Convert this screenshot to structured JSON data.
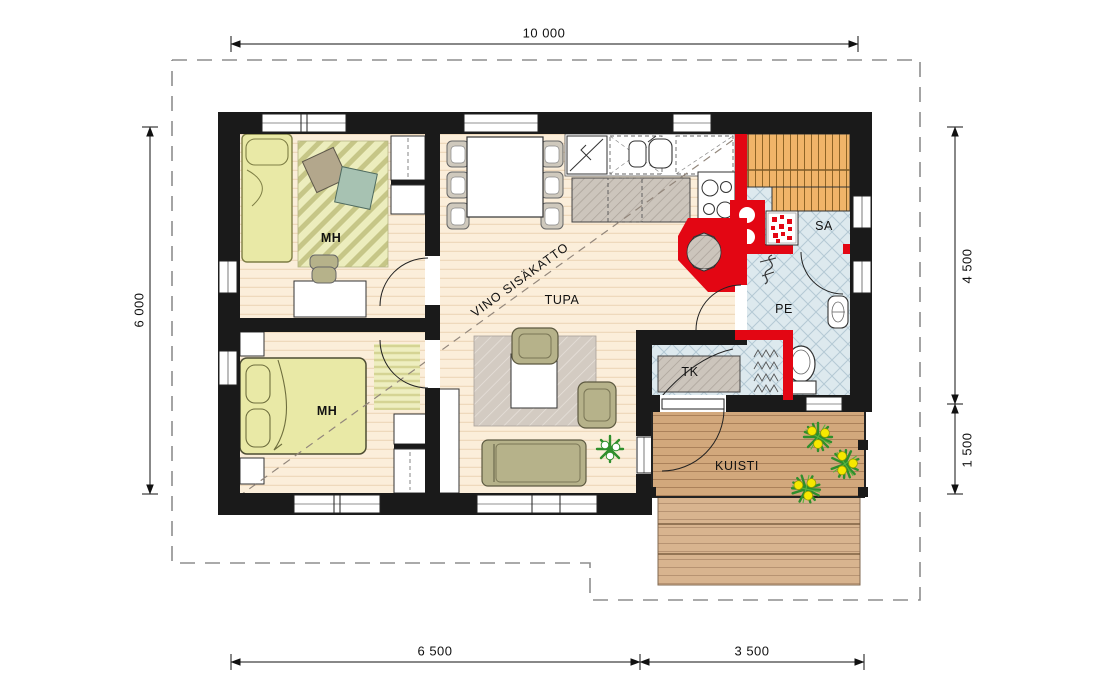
{
  "plan": {
    "rooms": {
      "bedroom_top": "MH",
      "bedroom_bottom": "MH",
      "living_room": "TUPA",
      "sauna": "SA",
      "washroom": "PE",
      "utility": "TK",
      "porch": "KUISTI"
    },
    "annotations": {
      "sloped_ceiling": "VINO SISÄKATTO"
    },
    "dimensions": {
      "top_width": "10 000",
      "left_height": "6 000",
      "right_upper": "4 500",
      "right_lower": "1 500",
      "bottom_left": "6 500",
      "bottom_right": "3 500"
    },
    "colors": {
      "wall": "#1a1a1a",
      "red_masonry": "#e30613",
      "wood_floor": "#fbeeda",
      "tile_floor": "#dde9ee",
      "sauna_bench": "#f0b469",
      "deck": "#d2a87c",
      "furniture_yellow": "#e9e9a6",
      "furniture_olive": "#b6b28a",
      "rug_gray": "#d3cbc2",
      "plant_green": "#2f8f2c",
      "flower_yellow": "#f6e800"
    }
  }
}
